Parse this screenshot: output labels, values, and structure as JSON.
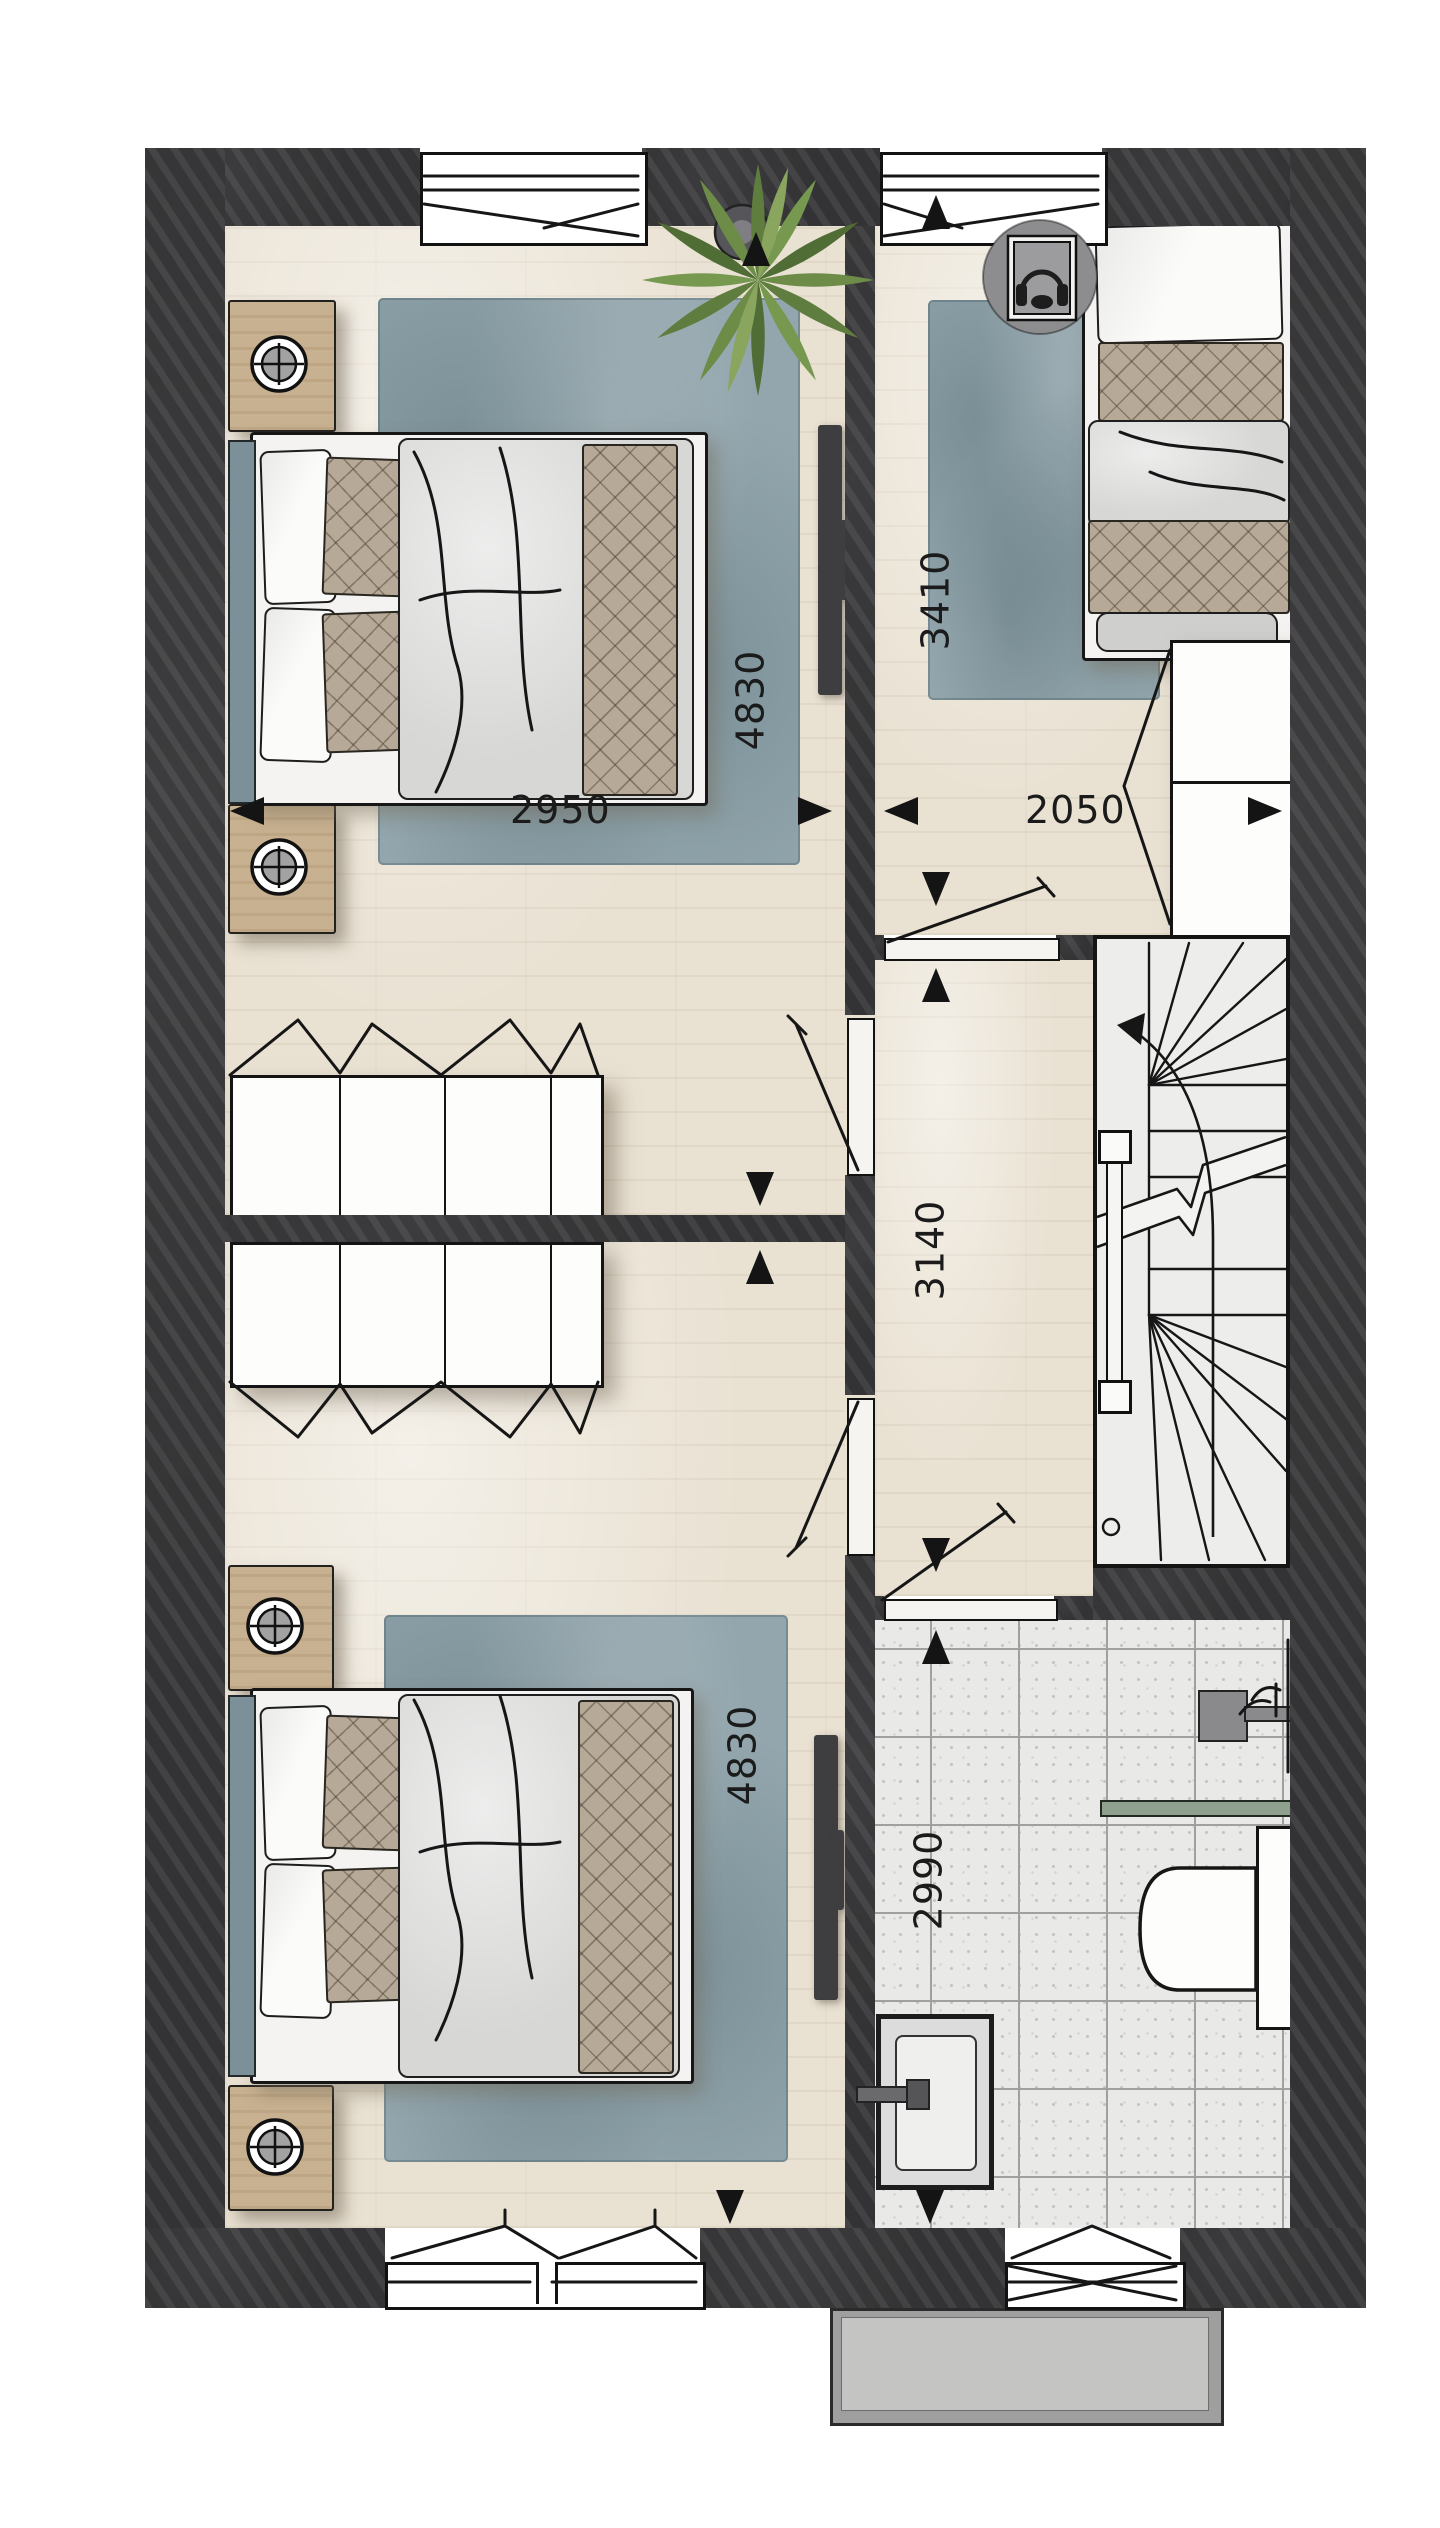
{
  "floor_plan": {
    "dimension_labels": {
      "bedroom1_width_mm": "2950",
      "bedroom1_length_mm": "4830",
      "bedroom2_length_mm": "4830",
      "bedroom3_length_mm": "3410",
      "bedroom3_width_mm": "2050",
      "landing_length_mm": "3140",
      "bathroom_length_mm": "2990"
    },
    "icons": {
      "table_lamp": "lamp-icon",
      "headphones": "headphones-icon",
      "plant": "plant-icon",
      "tv": "tv-icon",
      "shower": "shower-icon",
      "toilet": "toilet-icon",
      "washbasin": "washbasin-icon",
      "stairs_direction": "stairs-up-arrow-icon"
    },
    "colors": {
      "wall": "#3a3a3c",
      "wood_floor": "#e9e1d2",
      "tile_floor": "#e9e9e7",
      "rug": "#93a6ad",
      "headboard_accent": "#7b9098",
      "quilt": "#b7a997",
      "plant_green": "#6c8c48",
      "porch_slab": "#c4c4c3"
    }
  }
}
